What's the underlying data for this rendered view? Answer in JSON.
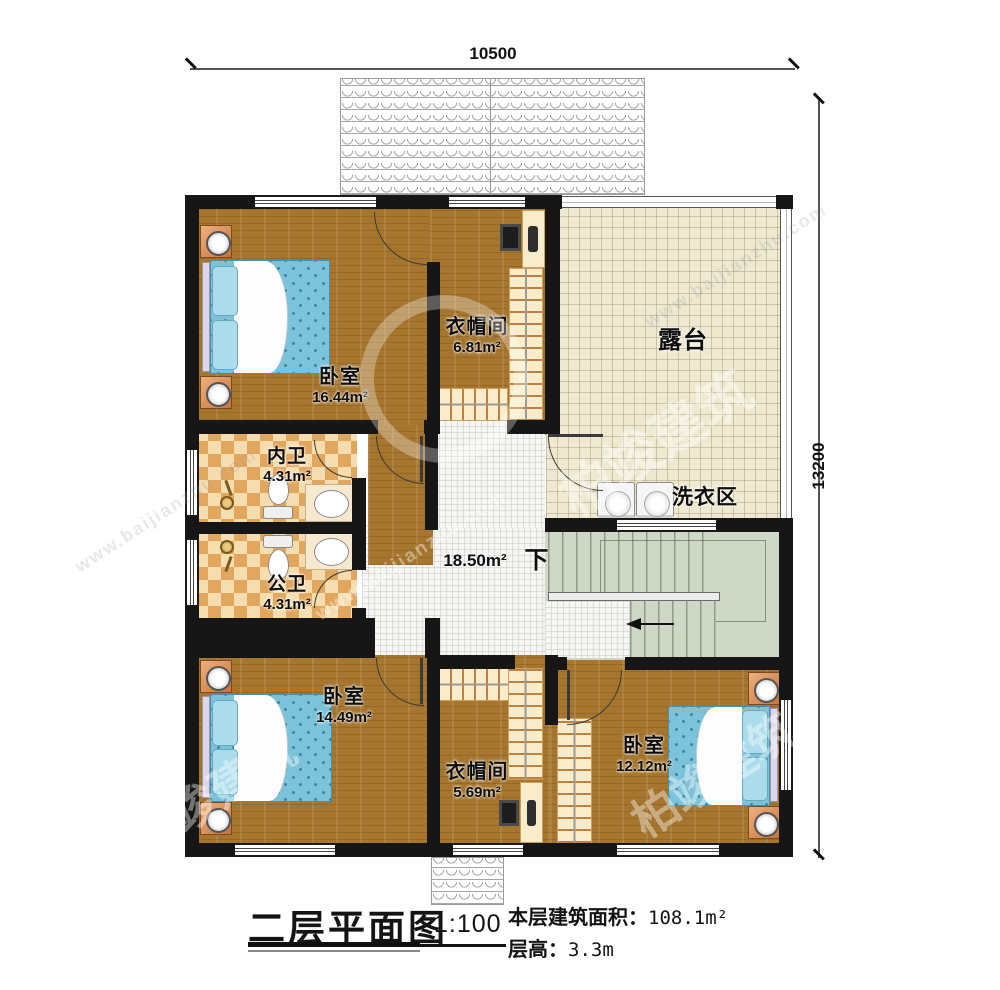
{
  "dimensions": {
    "top": "10500",
    "right": "13200"
  },
  "rooms": {
    "bedroom1": {
      "name": "卧室",
      "area": "16.44m²"
    },
    "cloakroom1": {
      "name": "衣帽间",
      "area": "6.81m²"
    },
    "terrace": {
      "name": "露台"
    },
    "ensuite_bath": {
      "name": "内卫",
      "area": "4.31m²"
    },
    "public_bath": {
      "name": "公卫",
      "area": "4.31m²"
    },
    "hall": {
      "area": "18.50m²",
      "down_label": "下"
    },
    "laundry": {
      "name": "洗衣区"
    },
    "bedroom2": {
      "name": "卧室",
      "area": "14.49m²"
    },
    "cloakroom2": {
      "name": "衣帽间",
      "area": "5.69m²"
    },
    "bedroom3": {
      "name": "卧室",
      "area": "12.12m²"
    }
  },
  "title_block": {
    "title": "二层平面图",
    "scale": "1:100",
    "area_label": "本层建筑面积：",
    "area_value": "108.1m²",
    "height_label": "层高：",
    "height_value": "3.3m"
  },
  "watermark": {
    "brand": "柏竣建筑",
    "url": "www.baijianzhu.com"
  },
  "colors": {
    "wall": "#161616",
    "wood_floor": "#a6762f",
    "terrace_tile": "#f0e9d2",
    "bathroom_tile": "#e2a75e",
    "hall_tile": "#f6f6f4",
    "stairs": "#cfd8c6",
    "bed": "#7cc3da",
    "furniture_accent": "#e8a06a"
  }
}
